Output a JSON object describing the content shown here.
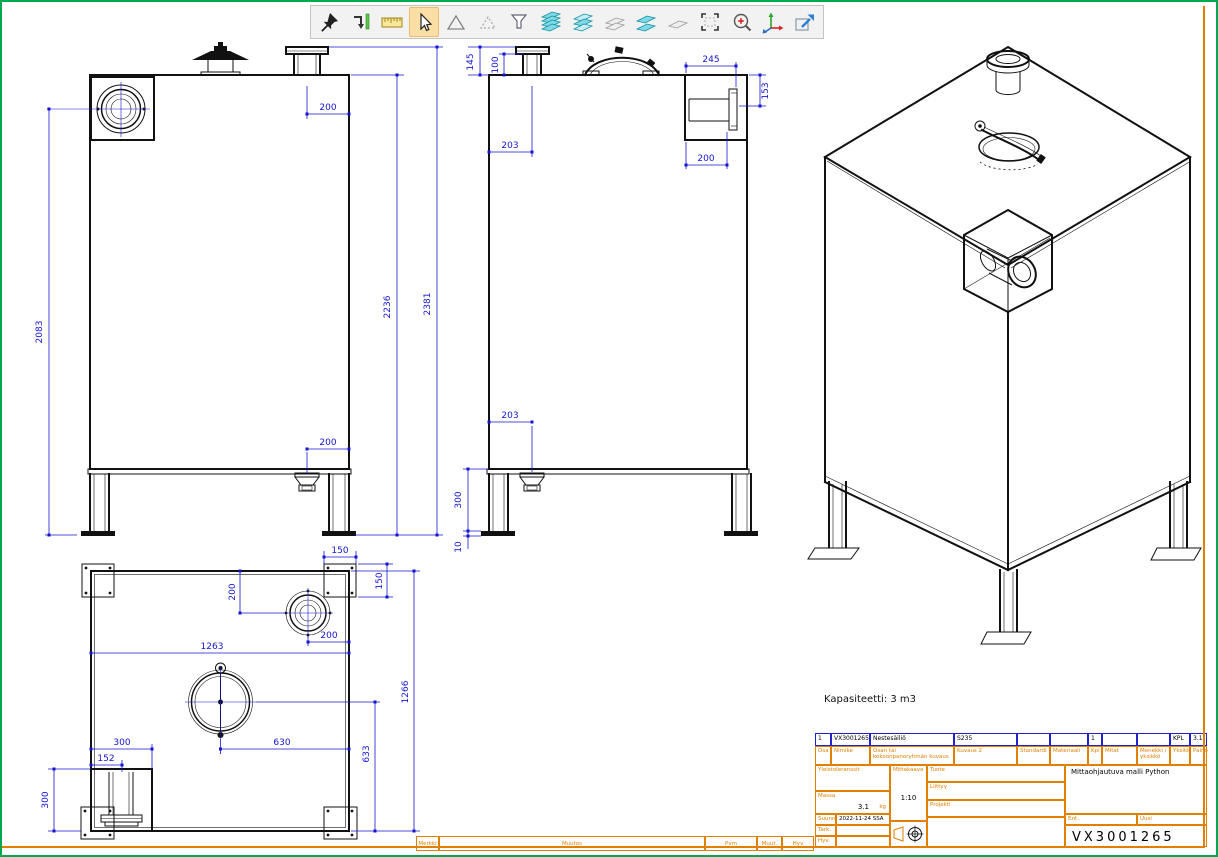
{
  "toolbar": {
    "active_tool": "select",
    "tools": [
      "pin",
      "dimension-update",
      "ruler",
      "select",
      "polygon",
      "polygon-ghost",
      "filter",
      "layers-stack",
      "layers-multi",
      "layers-flat",
      "layers-pair",
      "layer-single",
      "area-select",
      "zoom-in",
      "axes",
      "new-view"
    ]
  },
  "views": {
    "front": {
      "dims": {
        "height_left": "2083",
        "height_inner": "2236",
        "height_total": "2381",
        "nozzle_offset": "200",
        "drain_offset": "200"
      }
    },
    "side": {
      "dims": {
        "flange_total_h": "145",
        "flange_neck_h": "100",
        "nozzle_offset": "203",
        "recess_width": "245",
        "recess_height": "153",
        "recess_flange_offset": "200",
        "drain_offset": "203",
        "leg_height": "300",
        "foot_thickness": "10"
      }
    },
    "top": {
      "dims": {
        "plate_width": "150",
        "plate_height": "150",
        "conn_from_top": "200",
        "conn_from_right": "200",
        "tank_width": "1263",
        "tank_depth": "1266",
        "manhole_from_right": "630",
        "manhole_from_bottom": "633",
        "recess_width": "300",
        "recess_center": "152",
        "recess_depth": "300"
      }
    },
    "iso": {
      "caption": "Kapasiteetti: 3 m3"
    }
  },
  "title_block": {
    "parts_row": {
      "pos": "1",
      "code": "VX3001265",
      "name": "Nestesäiliö",
      "kuvaus2": "S235",
      "standardi": "",
      "materiaali": "",
      "kpl": "1",
      "mitat": "",
      "menekki": "",
      "yksikko": "KPL",
      "paino": "3.1"
    },
    "headers": {
      "osa": "Osa",
      "nimike": "Nimike",
      "kuvaus": "Osan tai kokoonpanoryhmän kuvaus",
      "kuvaus2": "Kuvaus 2",
      "standardi": "Standardi",
      "materiaali": "Materiaali",
      "kpl": "Kpl",
      "mitat": "Mitat",
      "menekki": "Menekki / yksikkö",
      "yksikko": "Yksikkö",
      "paino": "Paino"
    },
    "labels": {
      "yleistoleranssit": "Yleistoleranssit",
      "massa": "Massa",
      "mittakaava": "Mittakaava",
      "tuote": "Tuote",
      "liittyy": "Liittyy",
      "projekti": "Projekti",
      "suunn": "Suunn",
      "tark": "Tark.",
      "hyv": "Hyv.",
      "ent": "Ent.",
      "uusi": "Uusi"
    },
    "values": {
      "massa": "3.1",
      "massa_unit": "kg",
      "mittakaava": "1:10",
      "suunn_date": "2022-11-24 SSA",
      "product": "Mittaohjautuva malli Python",
      "drawing_number": "VX3001265"
    }
  },
  "revision_row": {
    "merkki": "Merkki",
    "muutos": "Muutos",
    "pvm": "Pvm",
    "muut": "Muut.",
    "hyv": "Hyv"
  }
}
